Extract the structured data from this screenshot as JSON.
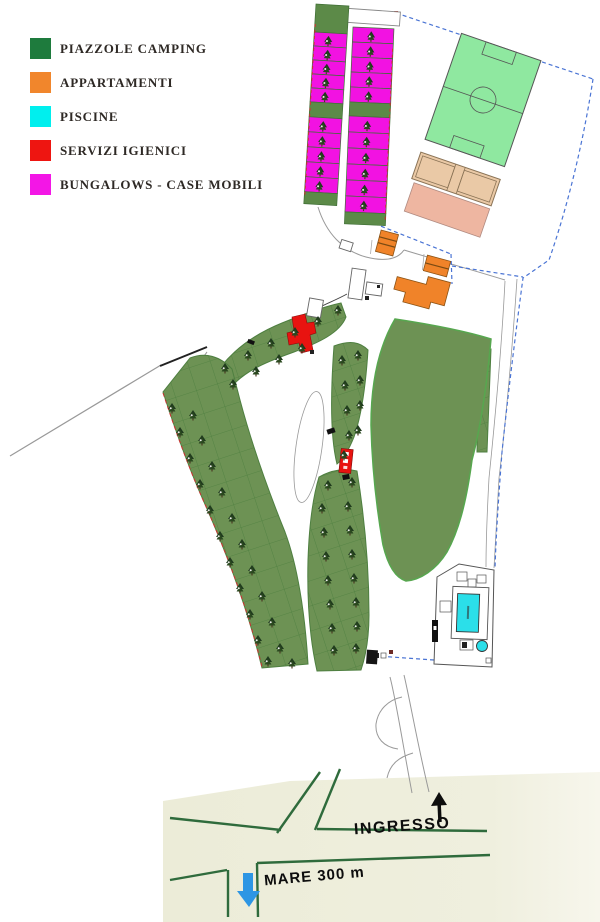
{
  "legend": {
    "items": [
      {
        "id": "piazzole",
        "label": "PIAZZOLE CAMPING",
        "color": "#1E7B3D"
      },
      {
        "id": "appartamenti",
        "label": "APPARTAMENTI",
        "color": "#F1862C"
      },
      {
        "id": "piscine",
        "label": "PISCINE",
        "color": "#00EFEE"
      },
      {
        "id": "servizi",
        "label": "SERVIZI IGIENICI",
        "color": "#EE1511"
      },
      {
        "id": "bungalows",
        "label": "BUNGALOWS - CASE MOBILI",
        "color": "#F316E6"
      }
    ]
  },
  "labels": {
    "entrance": "INGRESSO",
    "sea": "MARE 300 m"
  },
  "map": {
    "colors": {
      "camping": "#6D9254",
      "camping_line": "#4E7F40",
      "field_border": "#57A74F",
      "soccer": "#8FE8A0",
      "court": "#EAC9A6",
      "pink": "#EEB6A1",
      "orange": "#F08329",
      "red": "#E81310",
      "magenta": "#F212E2",
      "strip_green": "#5C8A48",
      "cyan": "#2BDFE9",
      "boundary": "#4A74D4",
      "road_green": "#2F6B3C",
      "beige": "#EDEDD9",
      "arrow_blue": "#2D96E4"
    },
    "bungalow_strips": [
      {
        "x": 316,
        "y": 4,
        "rot": 3.5,
        "width": 33,
        "red_edge": "left",
        "cells": [
          {
            "type": "green",
            "h": 28
          },
          {
            "type": "plot",
            "h": 14
          },
          {
            "type": "plot",
            "h": 14
          },
          {
            "type": "plot",
            "h": 14
          },
          {
            "type": "plot",
            "h": 14
          },
          {
            "type": "plot",
            "h": 14
          },
          {
            "type": "green",
            "h": 15
          },
          {
            "type": "plot",
            "h": 15
          },
          {
            "type": "plot",
            "h": 15
          },
          {
            "type": "plot",
            "h": 15
          },
          {
            "type": "plot",
            "h": 15
          },
          {
            "type": "plot",
            "h": 15
          },
          {
            "type": "green",
            "h": 12
          }
        ]
      },
      {
        "x": 353,
        "y": 27,
        "rot": 2.5,
        "width": 41,
        "red_edge": "right",
        "cells": [
          {
            "type": "plot",
            "h": 15
          },
          {
            "type": "plot",
            "h": 15
          },
          {
            "type": "plot",
            "h": 15
          },
          {
            "type": "plot",
            "h": 15
          },
          {
            "type": "plot",
            "h": 15
          },
          {
            "type": "green",
            "h": 14
          },
          {
            "type": "plot",
            "h": 16
          },
          {
            "type": "plot",
            "h": 16
          },
          {
            "type": "plot",
            "h": 16
          },
          {
            "type": "plot",
            "h": 16
          },
          {
            "type": "plot",
            "h": 16
          },
          {
            "type": "plot",
            "h": 16
          },
          {
            "type": "green",
            "h": 12
          }
        ]
      }
    ],
    "trees": [
      [
        225,
        368
      ],
      [
        248,
        355
      ],
      [
        271,
        343
      ],
      [
        295,
        332
      ],
      [
        318,
        321
      ],
      [
        338,
        310
      ],
      [
        233,
        384
      ],
      [
        256,
        371
      ],
      [
        279,
        359
      ],
      [
        302,
        348
      ],
      [
        342,
        360
      ],
      [
        358,
        355
      ],
      [
        345,
        385
      ],
      [
        360,
        380
      ],
      [
        347,
        410
      ],
      [
        360,
        405
      ],
      [
        349,
        435
      ],
      [
        358,
        430
      ],
      [
        344,
        455
      ],
      [
        172,
        408
      ],
      [
        193,
        415
      ],
      [
        180,
        432
      ],
      [
        202,
        440
      ],
      [
        190,
        458
      ],
      [
        212,
        466
      ],
      [
        200,
        484
      ],
      [
        222,
        492
      ],
      [
        210,
        510
      ],
      [
        232,
        518
      ],
      [
        220,
        536
      ],
      [
        242,
        544
      ],
      [
        230,
        562
      ],
      [
        252,
        570
      ],
      [
        240,
        588
      ],
      [
        262,
        596
      ],
      [
        250,
        614
      ],
      [
        272,
        622
      ],
      [
        258,
        640
      ],
      [
        280,
        648
      ],
      [
        268,
        661
      ],
      [
        292,
        663
      ],
      [
        328,
        485
      ],
      [
        352,
        482
      ],
      [
        322,
        508
      ],
      [
        348,
        506
      ],
      [
        324,
        532
      ],
      [
        350,
        530
      ],
      [
        326,
        556
      ],
      [
        352,
        554
      ],
      [
        328,
        580
      ],
      [
        354,
        578
      ],
      [
        330,
        604
      ],
      [
        356,
        602
      ],
      [
        332,
        628
      ],
      [
        357,
        626
      ],
      [
        334,
        650
      ],
      [
        356,
        648
      ]
    ]
  }
}
